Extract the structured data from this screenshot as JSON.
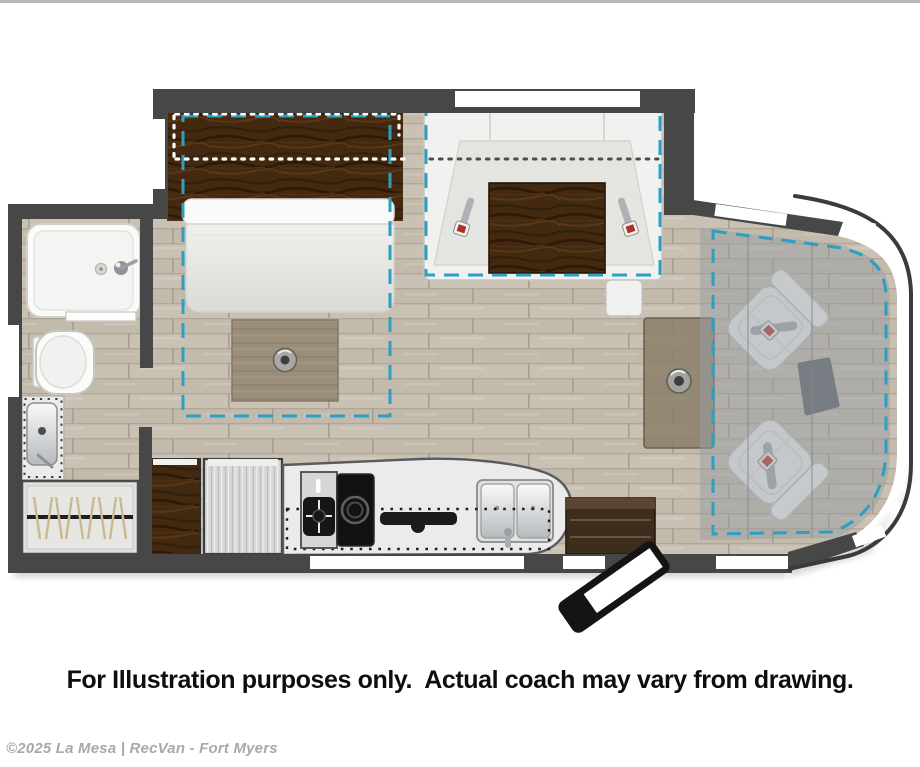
{
  "page": {
    "background": "#ffffff",
    "top_border_color": "#b9b9b9"
  },
  "caption": {
    "text": "For Illustration purposes only.  Actual coach may vary from drawing."
  },
  "footer": {
    "copyright": "©2025 La Mesa | RecVan - Fort Myers"
  },
  "floorplan": {
    "type": "motorhome-floorplan-top-view",
    "colors": {
      "wall": "#474747",
      "slideout_dash_accent": "#2d9fc4",
      "overhead_cabinet_dots": "#ffffff",
      "counter_dotted_outline": "#1e1e1e",
      "floor_wood": "#c9c1b3",
      "dark_wood": "#42290f",
      "mid_wood_table": "#9a8d7a",
      "appliance_silver": "#d6d8da",
      "seat_white": "#f3f3f1",
      "cab_overlay_gray": "#979da3",
      "seatbelt_buckle_red": "#ac3129"
    },
    "fixtures": [
      "shower",
      "toilet",
      "bathroom-sink",
      "wardrobe",
      "murphy-bed",
      "bedroom-table",
      "overhead-cabinets",
      "u-shaped-dinette",
      "dinette-table",
      "seatbelts",
      "kitchen-cabinet",
      "refrigerator",
      "kitchen-counter",
      "two-burner-stove",
      "glass-cooktop-cover",
      "flip-faucet",
      "double-sink",
      "entry-cabinet",
      "entry-step",
      "pedestal-table",
      "cab-swivel-seat-driver",
      "cab-swivel-seat-passenger",
      "drop-down-bunk-outline",
      "slide-out-outline-bedroom",
      "slide-out-outline-dinette"
    ]
  }
}
